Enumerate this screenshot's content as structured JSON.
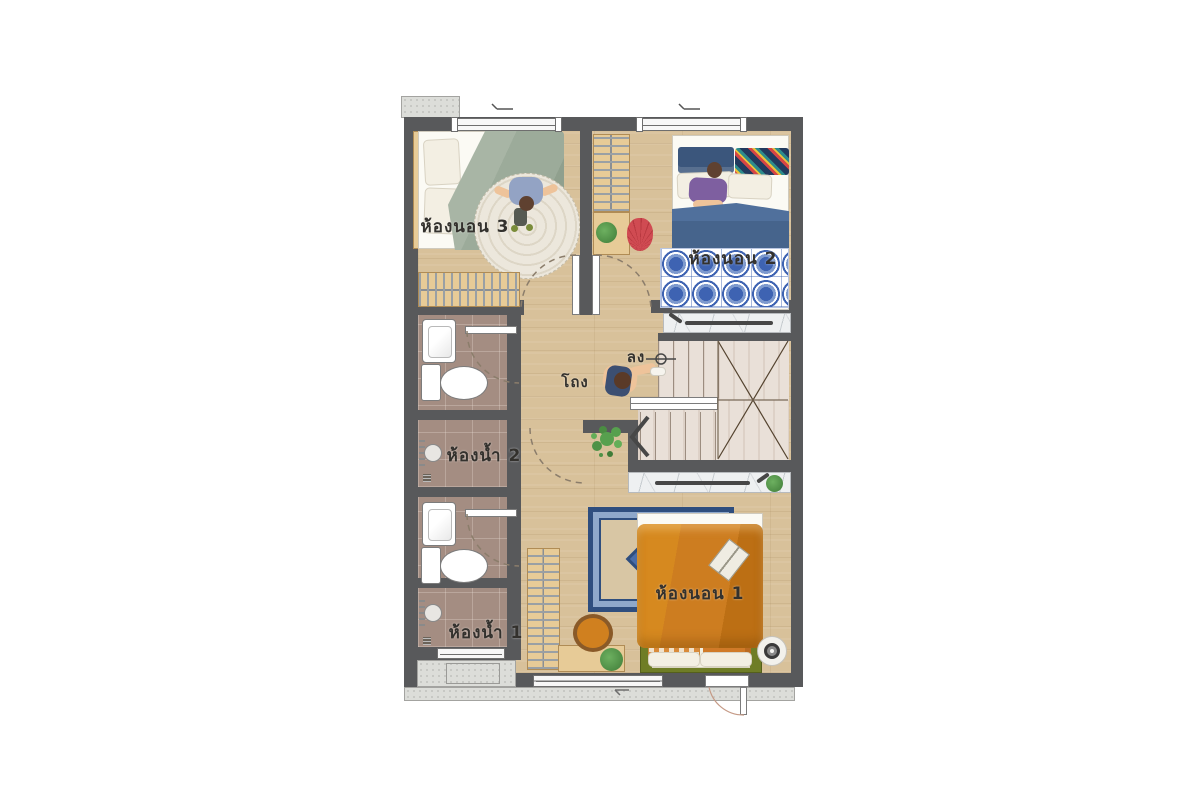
{
  "meta": {
    "type": "architectural-floor-plan",
    "style": "top-down furnished plan, Thai labels"
  },
  "labels": {
    "bedroom3": "ห้องนอน 3",
    "bedroom2": "ห้องนอน 2",
    "bedroom1": "ห้องนอน 1",
    "bathroom2": "ห้องน้ำ 2",
    "bathroom1": "ห้องน้ำ 1",
    "hall": "โถง",
    "stairs_down": "ลง"
  },
  "colors": {
    "wall": "#58595b",
    "wood_floor": "#d8c19a",
    "stair_wood": "#e9e0d8",
    "bathroom_tile": "#a48d82",
    "concrete": "#dcddd9",
    "marble": "#eef0f1",
    "sage_duvet": "#9cab9a",
    "denim_duvet": "#46648c",
    "orange_duvet": "#cd7d20",
    "green_bedframe": "#6f7d26",
    "blue_rug": "#3e63b2",
    "red_chair": "#d04b52",
    "orange_chair": "#d0801f",
    "plant_green": "#57a04e",
    "label_text": "#33312d"
  }
}
